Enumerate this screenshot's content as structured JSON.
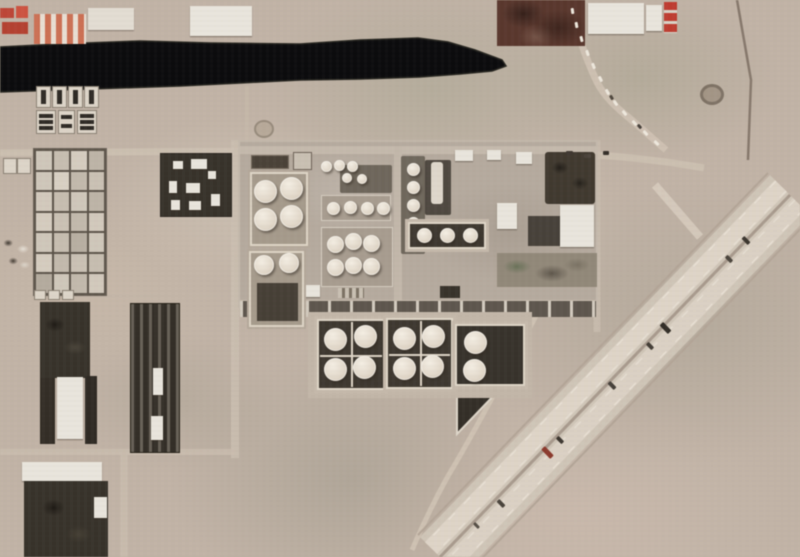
{
  "meta": {
    "image_type": "satellite photograph",
    "subject": "oil refinery and tank farm complex beside a dark canal, desert terrain, diagonal divided highway at lower right",
    "visible_text": "none"
  },
  "palette": {
    "base": "#c1b3a5",
    "water": "#0b0b0d",
    "pavement": "#b5aa9d",
    "tank": "#ece4d6",
    "containment-floor": "#3e3830",
    "berm": "#ded5c5",
    "highway": "#cfc5b6",
    "lane": "#ded4c6",
    "median": "#a89a8c",
    "road": "#cabdae",
    "dark-block": "#37322a",
    "white-building": "#e9e5dc",
    "red-building": "#c14536",
    "maroon-field": "#5a372c",
    "laydown": "#918878"
  },
  "features": {
    "canal": {
      "label": "dark water canal strip across upper image",
      "approx_length_px": 505
    },
    "highway": {
      "label": "divided multi-lane highway running diagonally NE to SW",
      "vehicle_count": 9
    },
    "basin_grid": {
      "label": "evaporation pond grid",
      "rows": 7,
      "cols": 4,
      "shades": [
        "#cfc7b9",
        "#c6bdaf",
        "#d5ccbe",
        "#bdb4a6",
        "#cfc7b9",
        "#d8d0c2",
        "#c2b9ab",
        "#cac1b3",
        "#d2c9bb",
        "#c6bdaf",
        "#cfc7b9",
        "#bdb4a6",
        "#d5ccbe",
        "#cac1b3",
        "#c2b9ab",
        "#d2c9bb",
        "#cfc7b9",
        "#c6bdaf",
        "#b8afa1",
        "#cfc7b9",
        "#d5ccbe",
        "#c2b9ab",
        "#cac1b3",
        "#c6bdaf",
        "#b4ab9d",
        "#cfc7b9",
        "#c2b9ab",
        "#d2c9bb"
      ]
    },
    "settling_block": {
      "label": "dark settling cells south of canal",
      "top_cells": 4,
      "lower_cells": 3
    },
    "tank_groups": {
      "north_containment": {
        "label": "bermed containment, 4 large tanks",
        "box": [
          250,
          172,
          58,
          74
        ],
        "dia": 23,
        "centers": [
          [
            15,
            19
          ],
          [
            41,
            16
          ],
          [
            15,
            47
          ],
          [
            41,
            44
          ]
        ]
      },
      "south_containment": {
        "label": "bermed containment, 2 tanks + dark pad",
        "box": [
          249,
          251,
          55,
          76
        ],
        "dia": 20,
        "centers": [
          [
            15,
            14
          ],
          [
            40,
            12
          ]
        ]
      },
      "row4": {
        "label": "row of 4 small tanks",
        "box": [
          321,
          195,
          70,
          26
        ],
        "dia": 13,
        "centers": [
          [
            12,
            13
          ],
          [
            29,
            12
          ],
          [
            46,
            13
          ],
          [
            62,
            13
          ]
        ]
      },
      "cluster6": {
        "label": "cluster of 6 tanks",
        "box": [
          321,
          227,
          72,
          60
        ],
        "dia": 17,
        "centers": [
          [
            14,
            17
          ],
          [
            32,
            14
          ],
          [
            50,
            16
          ],
          [
            14,
            40
          ],
          [
            32,
            38
          ],
          [
            50,
            39
          ]
        ]
      },
      "row3_top": {
        "label": "row of 3 small tanks",
        "box": [
          316,
          155,
          42,
          22
        ],
        "dia": 11,
        "centers": [
          [
            10,
            11
          ],
          [
            23,
            10
          ],
          [
            36,
            11
          ]
        ]
      },
      "mid_pair": {
        "label": "pair of small process tanks",
        "box": [
          338,
          168,
          34,
          20
        ],
        "dia": 10,
        "centers": [
          [
            9,
            10
          ],
          [
            24,
            11
          ]
        ]
      },
      "column5": {
        "label": "vertical column of 5 small tanks",
        "box": [
          401,
          156,
          24,
          98
        ],
        "dia": 13,
        "centers": [
          [
            12,
            13
          ],
          [
            12,
            31
          ],
          [
            12,
            49
          ],
          [
            12,
            67
          ],
          [
            12,
            85
          ]
        ]
      },
      "dark_row3": {
        "label": "3 tanks in dark-floor bay",
        "box": [
          408,
          222,
          78,
          27
        ],
        "dia": 15,
        "centers": [
          [
            16,
            13
          ],
          [
            39,
            13
          ],
          [
            62,
            13
          ]
        ]
      },
      "contA": {
        "label": "south containment A, 4 tanks",
        "box": [
          317,
          319,
          68,
          71
        ],
        "dia": 23,
        "centers": [
          [
            18,
            20
          ],
          [
            48,
            17
          ],
          [
            18,
            50
          ],
          [
            47,
            48
          ]
        ]
      },
      "contB": {
        "label": "south containment B, 4 tanks",
        "box": [
          386,
          318,
          67,
          71
        ],
        "dia": 23,
        "centers": [
          [
            18,
            20
          ],
          [
            47,
            18
          ],
          [
            18,
            50
          ],
          [
            46,
            48
          ]
        ]
      },
      "contC": {
        "label": "south containment C, 2 tanks on dark floor",
        "box": [
          455,
          324,
          70,
          62
        ],
        "dia": 23,
        "centers": [
          [
            20,
            18
          ],
          [
            19,
            46
          ]
        ]
      }
    },
    "vehicles": [
      {
        "x": 744,
        "y": 236,
        "w": 4,
        "h": 9,
        "c": "#3c362f",
        "r": -44
      },
      {
        "x": 727,
        "y": 255,
        "w": 4,
        "h": 8,
        "c": "#4a443c",
        "r": -44
      },
      {
        "x": 663,
        "y": 322,
        "w": 5,
        "h": 12,
        "c": "#322d27",
        "r": -44
      },
      {
        "x": 648,
        "y": 342,
        "w": 4,
        "h": 8,
        "c": "#443e37",
        "r": -44
      },
      {
        "x": 610,
        "y": 381,
        "w": 4,
        "h": 9,
        "c": "#45403a",
        "r": -44
      },
      {
        "x": 545,
        "y": 446,
        "w": 5,
        "h": 13,
        "c": "#8e392c",
        "r": -44
      },
      {
        "x": 558,
        "y": 436,
        "w": 4,
        "h": 8,
        "c": "#3c362f",
        "r": -44
      },
      {
        "x": 499,
        "y": 499,
        "w": 4,
        "h": 9,
        "c": "#4a443c",
        "r": -44
      },
      {
        "x": 475,
        "y": 522,
        "w": 3,
        "h": 7,
        "c": "#554e45",
        "r": -44
      },
      {
        "x": 566,
        "y": 151,
        "w": 7,
        "h": 4,
        "c": "#3f3831",
        "r": 0
      },
      {
        "x": 584,
        "y": 154,
        "w": 7,
        "h": 4,
        "c": "#4a433b",
        "r": 0
      },
      {
        "x": 603,
        "y": 151,
        "w": 6,
        "h": 4,
        "c": "#36302a",
        "r": 0
      },
      {
        "x": 571,
        "y": 8,
        "w": 3,
        "h": 6,
        "c": "#eee8dd",
        "r": -8
      },
      {
        "x": 575,
        "y": 22,
        "w": 3,
        "h": 6,
        "c": "#eee8dd",
        "r": -10
      },
      {
        "x": 580,
        "y": 36,
        "w": 3,
        "h": 6,
        "c": "#eee8dd",
        "r": -14
      },
      {
        "x": 586,
        "y": 50,
        "w": 3,
        "h": 6,
        "c": "#eee8dd",
        "r": -18
      },
      {
        "x": 592,
        "y": 63,
        "w": 3,
        "h": 6,
        "c": "#eee8dd",
        "r": -22
      },
      {
        "x": 599,
        "y": 76,
        "w": 3,
        "h": 6,
        "c": "#eee8dd",
        "r": -26
      },
      {
        "x": 606,
        "y": 89,
        "w": 3,
        "h": 6,
        "c": "#eee8dd",
        "r": -30
      },
      {
        "x": 610,
        "y": 95,
        "w": 3,
        "h": 5,
        "c": "#4e463c",
        "r": -32
      },
      {
        "x": 614,
        "y": 100,
        "w": 3,
        "h": 6,
        "c": "#eee8dd",
        "r": -34
      },
      {
        "x": 623,
        "y": 110,
        "w": 3,
        "h": 6,
        "c": "#eee8dd",
        "r": -38
      },
      {
        "x": 633,
        "y": 120,
        "w": 3,
        "h": 6,
        "c": "#eee8dd",
        "r": -40
      },
      {
        "x": 638,
        "y": 124,
        "w": 3,
        "h": 5,
        "c": "#46403a",
        "r": -41
      },
      {
        "x": 644,
        "y": 130,
        "w": 3,
        "h": 6,
        "c": "#eee8dd",
        "r": -42
      },
      {
        "x": 655,
        "y": 140,
        "w": 3,
        "h": 6,
        "c": "#eee8dd",
        "r": -44
      }
    ]
  }
}
